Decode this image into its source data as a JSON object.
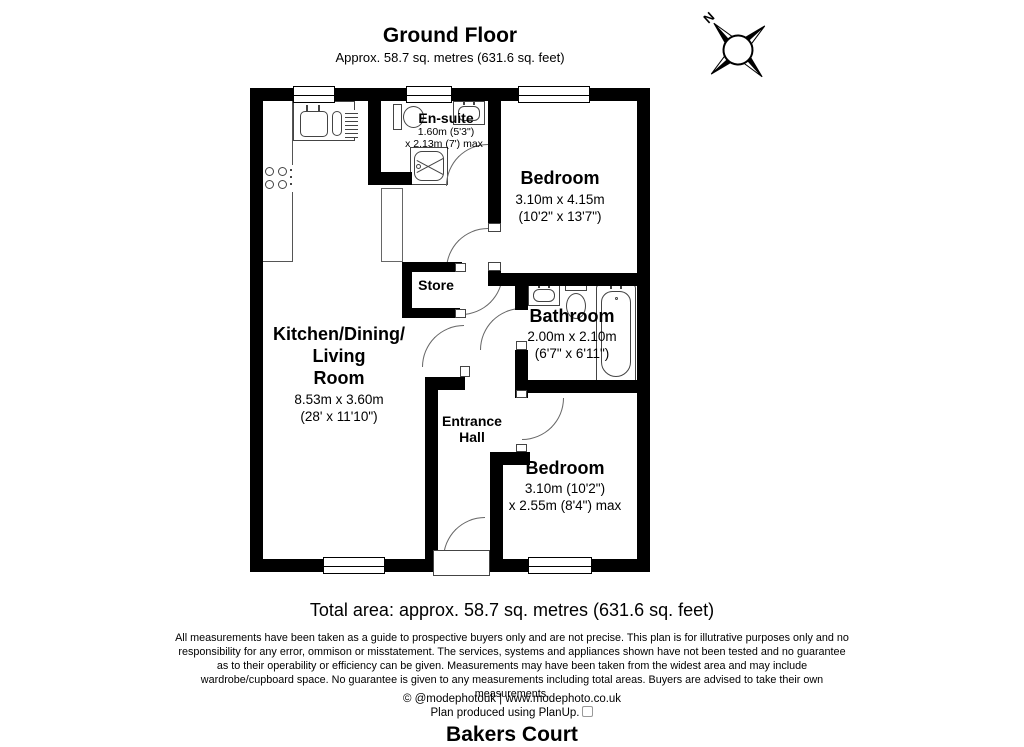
{
  "header": {
    "title": "Ground Floor",
    "subtitle": "Approx. 58.7 sq. metres (631.6 sq. feet)"
  },
  "compass": {
    "north_label": "N"
  },
  "rooms": {
    "ensuite": {
      "name": "En-suite",
      "dim1": "1.60m (5'3\")",
      "dim2": "x 2.13m (7') max"
    },
    "bedroom1": {
      "name": "Bedroom",
      "dim1": "3.10m x 4.15m",
      "dim2": "(10'2\" x 13'7\")"
    },
    "store": {
      "name": "Store"
    },
    "kitchen": {
      "name_line1": "Kitchen/Dining/",
      "name_line2": "Living",
      "name_line3": "Room",
      "dim1": "8.53m x 3.60m",
      "dim2": "(28' x 11'10\")"
    },
    "bathroom": {
      "name": "Bathroom",
      "dim1": "2.00m x 2.10m",
      "dim2": "(6'7\" x 6'11\")"
    },
    "hall": {
      "name_line1": "Entrance",
      "name_line2": "Hall"
    },
    "bedroom2": {
      "name": "Bedroom",
      "dim1": "3.10m (10'2\")",
      "dim2": "x 2.55m (8'4\") max"
    }
  },
  "fixtures": [
    "kitchen-sink-icon",
    "hob-icon",
    "toilet-icon",
    "wash-basin-icon",
    "shower-icon",
    "bathtub-icon",
    "window-icon",
    "door-arc-icon",
    "compass-rose-icon"
  ],
  "footer": {
    "total_area": "Total area: approx. 58.7 sq. metres (631.6 sq. feet)",
    "disclaimer": "All measurements have been taken as a guide to prospective buyers only and are not precise. This plan is for illutrative purposes only and no responsibility for any error, ommison or misstatement. The services, systems and appliances shown have not been tested and no guarantee as to their operability or efficiency can be given. Measurements may have been taken from the widest area and may include wardrobe/cupboard space. No guarantee is given to any measurements including total areas. Buyers are advised to take their own measurements.",
    "credit_line1": "© @modephotouk | www.modephoto.co.uk",
    "credit_line2": "Plan produced using PlanUp.",
    "property_name": "Bakers Court"
  },
  "colors": {
    "wall": "#000000",
    "fixture_line": "#444444",
    "arc_line": "#666666"
  }
}
